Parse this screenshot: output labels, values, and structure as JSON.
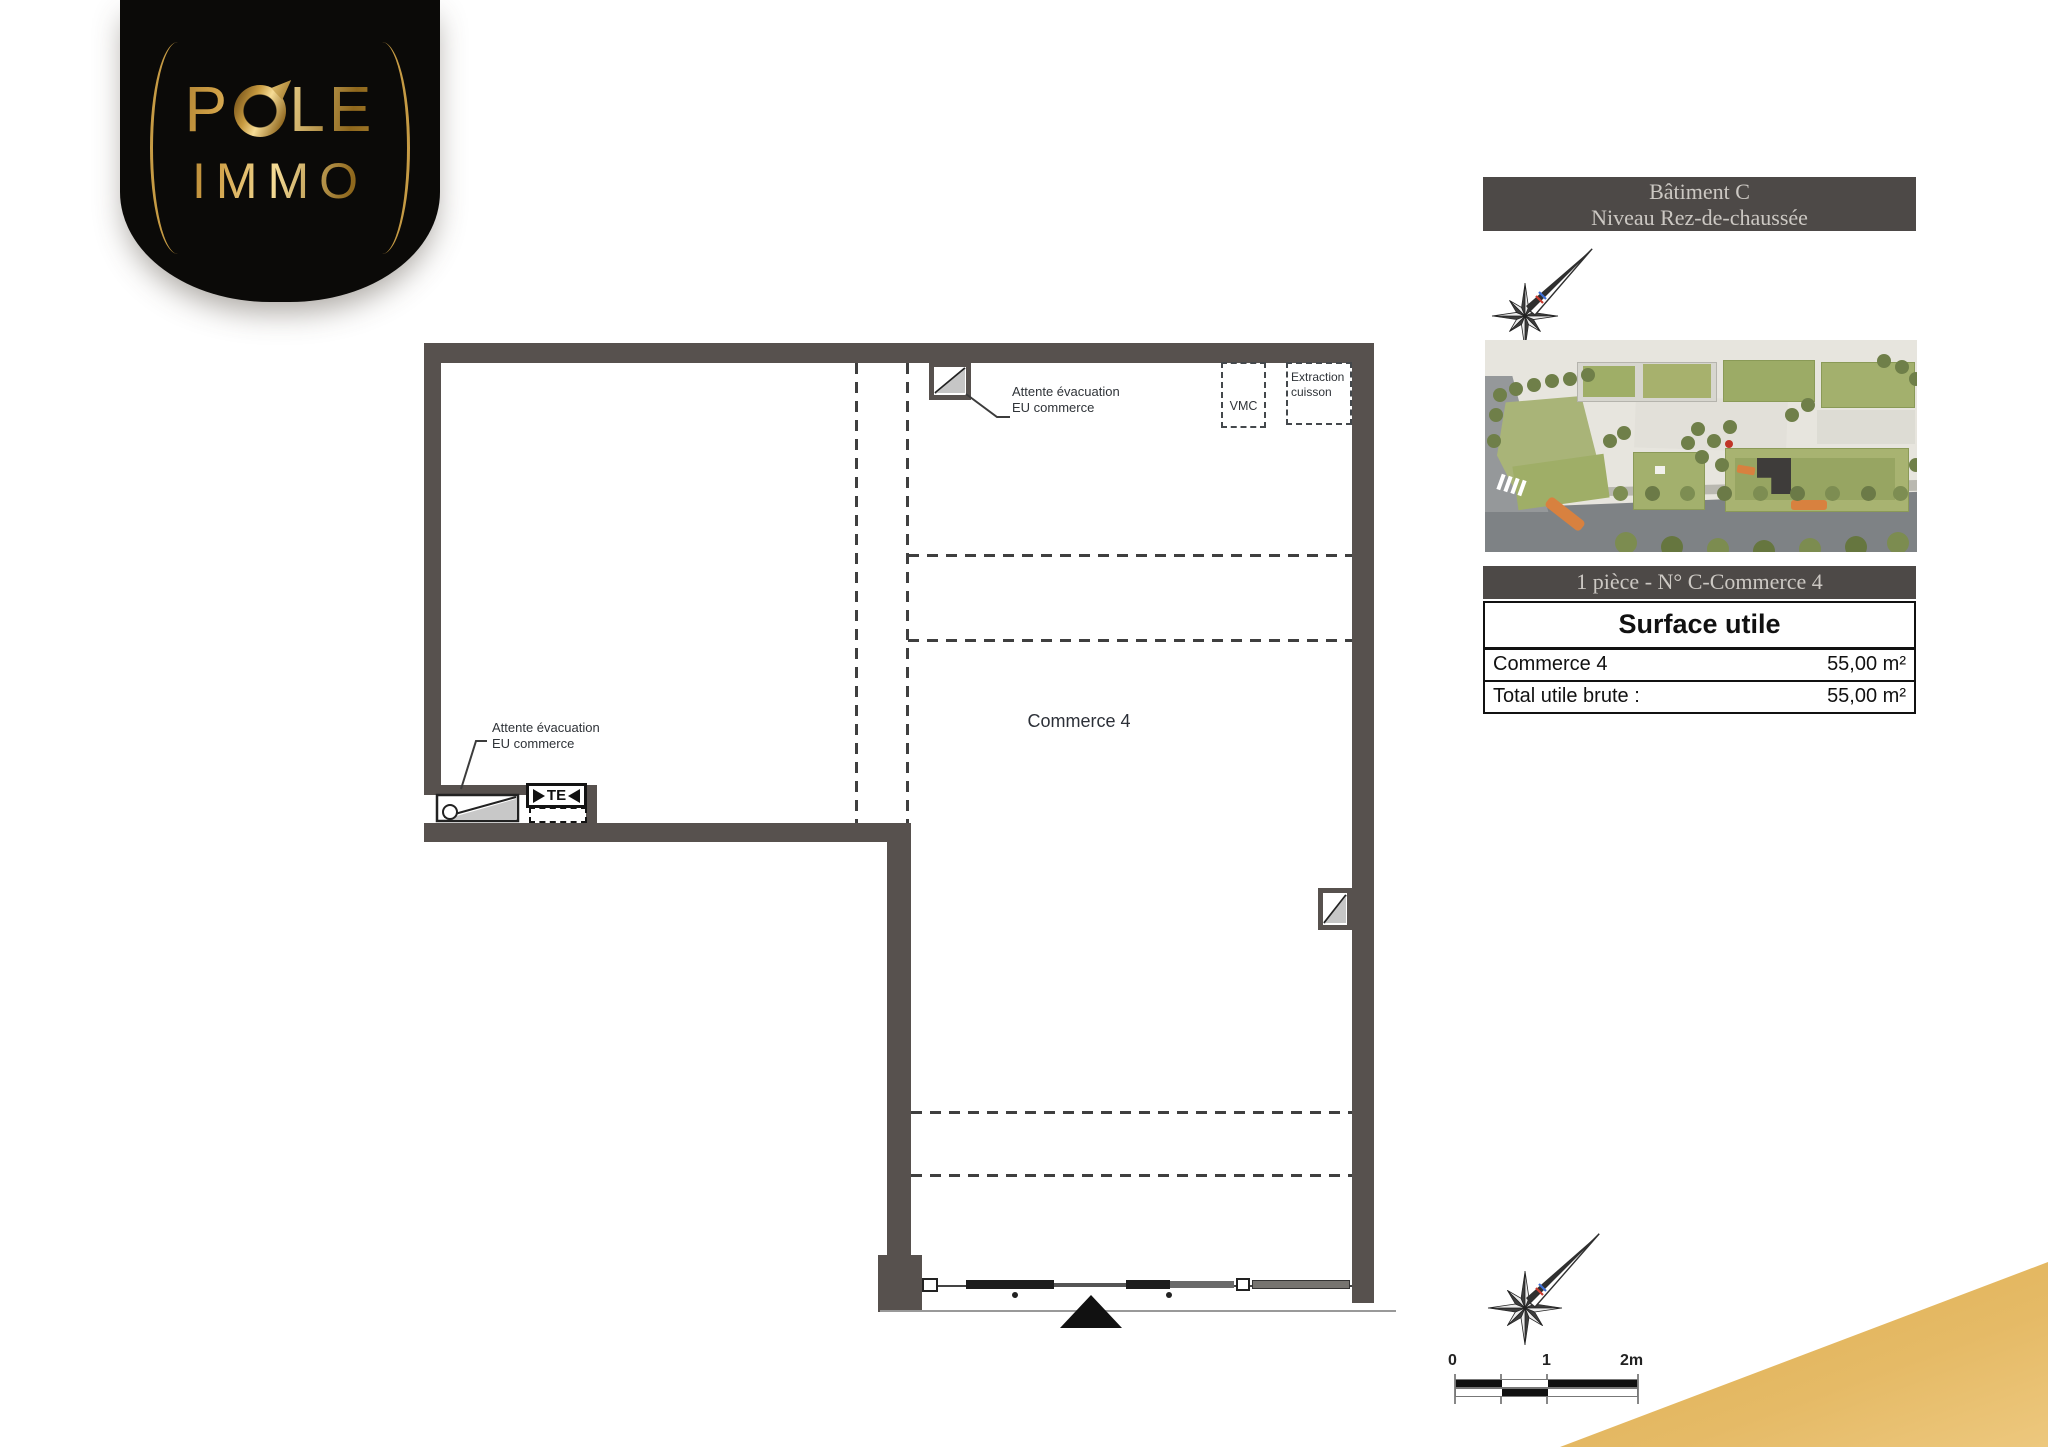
{
  "logo": {
    "line1": "POLE",
    "line2": "IMMO",
    "o_letter": "O"
  },
  "floor_plan": {
    "room_label": "Commerce 4",
    "annotation_top": {
      "line1": "Attente évacuation",
      "line2": "EU commerce"
    },
    "annotation_left": {
      "line1": "Attente évacuation",
      "line2": "EU commerce"
    },
    "vmc_label": "VMC",
    "extraction_label": {
      "line1": "Extraction",
      "line2": "cuisson"
    },
    "te_label": "TE"
  },
  "info_panel": {
    "header_line1": "Bâtiment C",
    "header_line2": "Niveau Rez-de-chaussée",
    "unit_bar": "1 pièce - N° C-Commerce 4",
    "surface_table": {
      "title": "Surface utile",
      "rows": [
        {
          "label": "Commerce 4",
          "value": "55,00 m²"
        },
        {
          "label": "Total utile brute :",
          "value": "55,00 m²"
        }
      ]
    }
  },
  "scale_bar": {
    "tick0": "0",
    "tick1": "1",
    "tick2": "2m"
  },
  "colors": {
    "wall": "#57514e",
    "header_bg": "#4d4947",
    "gold": "#e0b257",
    "accent_red": "#c03427"
  }
}
